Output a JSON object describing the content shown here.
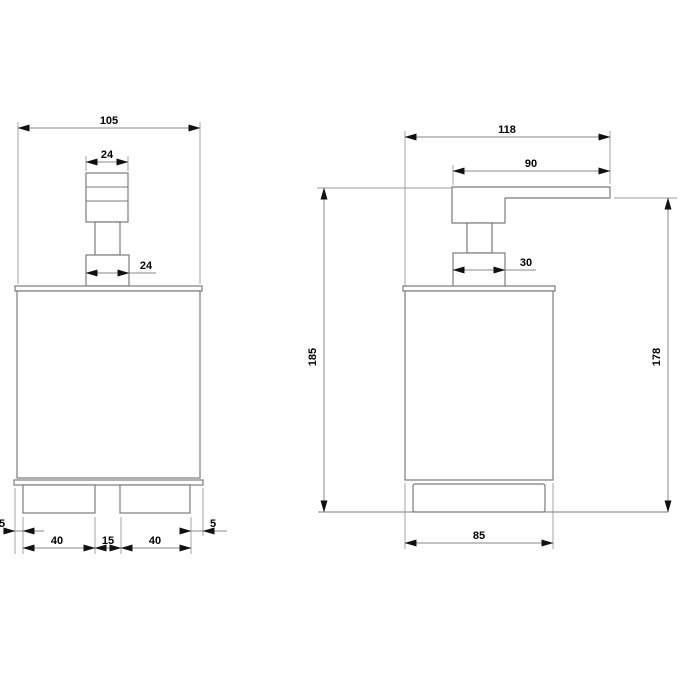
{
  "drawing": {
    "type": "technical-dimension-drawing",
    "views": {
      "front": {
        "dims": {
          "overall_width": "105",
          "pump_head_width": "24",
          "pump_collar_width": "24",
          "base_left_offset": "5",
          "base_left_width": "40",
          "base_gap": "15",
          "base_right_width": "40",
          "base_right_offset": "5"
        }
      },
      "side": {
        "dims": {
          "overall_depth": "118",
          "spout_length": "90",
          "pump_collar_depth": "30",
          "overall_height": "185",
          "spout_underside_height": "178",
          "base_depth": "85"
        }
      }
    },
    "colors": {
      "background": "#ffffff",
      "geometry_line": "#7b7b7b",
      "dimension_line": "#8a8a8a",
      "text": "#000000",
      "arrow": "#111111"
    }
  }
}
